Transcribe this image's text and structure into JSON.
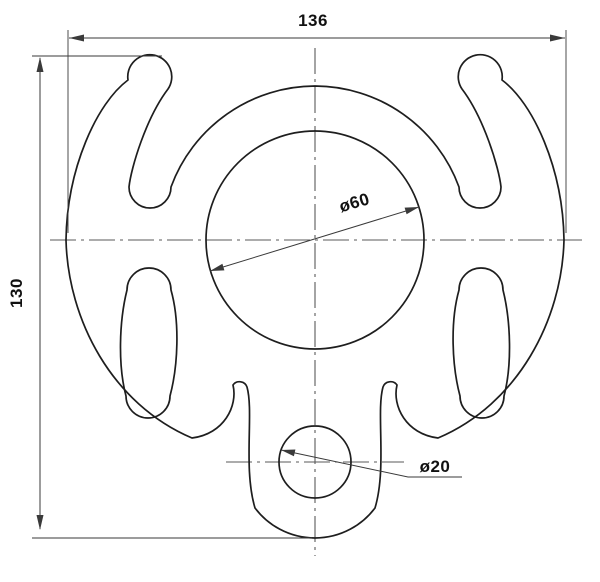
{
  "drawing": {
    "type": "2D technical drawing / mechanical part profile",
    "part": "rigging plate with two horns, two kidney slots, center hole and bottom eye",
    "dimensions": {
      "overall_width_label": "136",
      "overall_height_label": "130",
      "large_hole_label": "ø60",
      "small_hole_label": "ø20"
    }
  },
  "colors": {
    "outline": "#1e1e1e",
    "dimension": "#3a3a3a",
    "centerline": "#5a5a5a",
    "background": "#ffffff",
    "textcolor": "#111111"
  }
}
